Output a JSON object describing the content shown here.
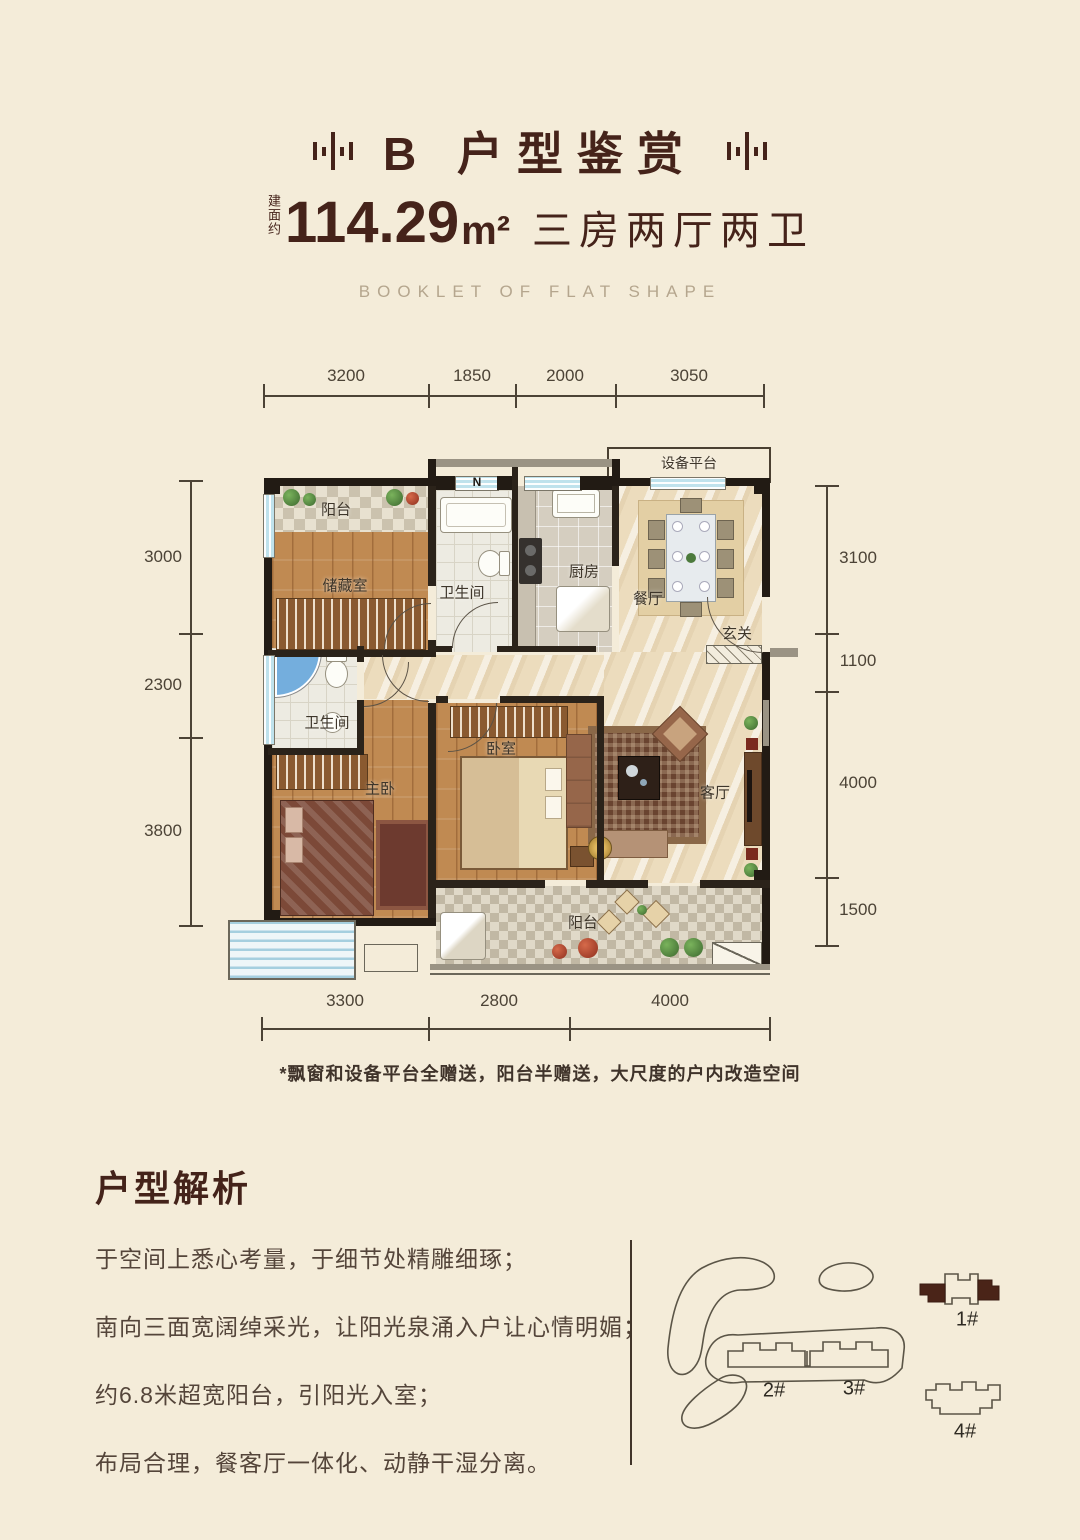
{
  "colors": {
    "background": "#f4ecd9",
    "accent": "#45231a",
    "dimension": "#4c4336",
    "body_text": "#54453a",
    "muted_caption": "#b5a68e",
    "wall": "#221b14",
    "highlight_building": "#4a2418"
  },
  "header": {
    "title": "B 户型鉴赏",
    "area_prefix": "建面约",
    "area_value": "114.29",
    "area_unit": "m²",
    "area_suffix": "三房两厅两卫",
    "english_caption": "BOOKLET OF FLAT SHAPE"
  },
  "floor_plan": {
    "compass": "N",
    "dimensions": {
      "top": [
        "3200",
        "1850",
        "2000",
        "3050"
      ],
      "left": [
        "3000",
        "2300",
        "3800"
      ],
      "right": [
        "3100",
        "1100",
        "4000",
        "1500"
      ],
      "bottom": [
        "3300",
        "2800",
        "4000"
      ]
    },
    "rooms": {
      "equipment_platform": "设备平台",
      "balcony_top": "阳台",
      "storage": "储藏室",
      "bath_top": "卫生间",
      "kitchen": "厨房",
      "dining": "餐厅",
      "entry": "玄关",
      "bath_mid": "卫生间",
      "master_bedroom": "主卧",
      "bedroom": "卧室",
      "living_room": "客厅",
      "balcony_bottom": "阳台"
    },
    "note": "*飘窗和设备平台全赠送，阳台半赠送，大尺度的户内改造空间"
  },
  "analysis": {
    "title": "户型解析",
    "lines": [
      "于空间上悉心考量，于细节处精雕细琢；",
      "南向三面宽阔绰采光，让阳光泉涌入户让心情明媚；",
      "约6.8米超宽阳台，引阳光入室；",
      "布局合理，餐客厅一体化、动静干湿分离。"
    ]
  },
  "site_plan": {
    "buildings": [
      {
        "label": "1#"
      },
      {
        "label": "2#"
      },
      {
        "label": "3#"
      },
      {
        "label": "4#"
      }
    ]
  }
}
